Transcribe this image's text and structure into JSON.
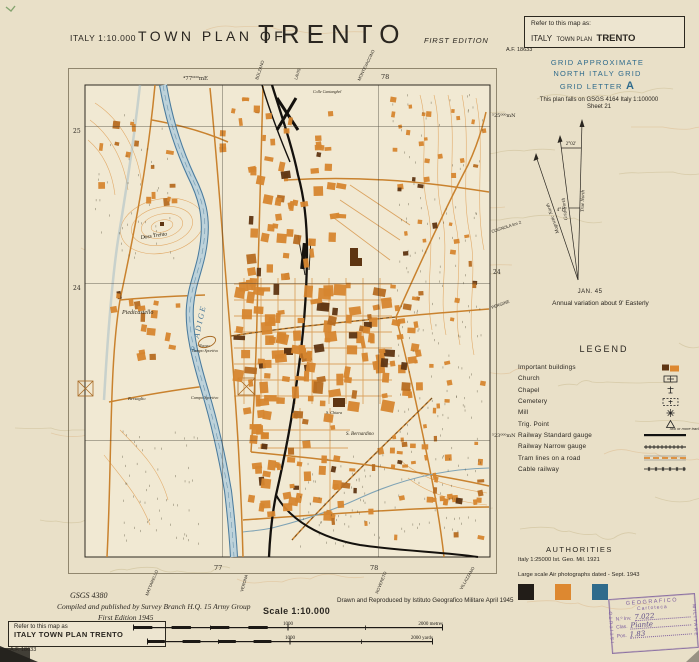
{
  "colors": {
    "accent_orange": "#d6862f",
    "dark_building": "#5e3512",
    "grid_blue": "#2f6b8c",
    "river_blue": "#4a7a9b",
    "stamp_purple": "#7d5e9e",
    "paper": "#e9e0c8"
  },
  "header": {
    "series_label": "ITALY 1:10.000",
    "title_prefix": "TOWN PLAN OF",
    "title": "TRENTO",
    "edition": "FIRST EDITION"
  },
  "refer_top": {
    "intro": "Refer to this map as:",
    "country": "ITALY",
    "series": "TOWN PLAN",
    "name": "TRENTO",
    "number": "A.F. 18633"
  },
  "grid_note": {
    "l1": "GRID APPROXIMATE",
    "l2": "NORTH ITALY GRID",
    "l3": "GRID LETTER",
    "letter": "A"
  },
  "falls_on": {
    "l1": "This plan falls on GSGS 4164 Italy 1:100000",
    "l2": "Sheet 21"
  },
  "declination": {
    "magnetic": "Magnetic North",
    "grid": "Grid North",
    "true_north": "True North",
    "angle_top": "2°02'",
    "angle_low": "4°11'",
    "date": "JAN. 45",
    "note": "Annual variation about 9' Easterly"
  },
  "legend": {
    "title": "LEGEND",
    "note": "Two or more tracks",
    "items": [
      {
        "label": "Important buildings",
        "symbol": "important-buildings"
      },
      {
        "label": "Church",
        "symbol": "church"
      },
      {
        "label": "Chapel",
        "symbol": "chapel"
      },
      {
        "label": "Cemetery",
        "symbol": "cemetery"
      },
      {
        "label": "Mill",
        "symbol": "mill"
      },
      {
        "label": "Trig. Point",
        "symbol": "trig-point"
      },
      {
        "label": "Railway Standard gauge",
        "symbol": "railway-standard",
        "note": true
      },
      {
        "label": "Railway Narrow gauge",
        "symbol": "railway-narrow"
      },
      {
        "label": "Tram lines on a road",
        "symbol": "tram-lines"
      },
      {
        "label": "Cable railway",
        "symbol": "cable-railway"
      }
    ]
  },
  "authorities": {
    "title": "AUTHORITIES",
    "source1": "Italy 1:25000  Ist. Geo. Mil.  1921",
    "source2": "Large scale Air photographs dated - Sept. 1943"
  },
  "swatches": [
    "#221d18",
    "#dd8830",
    "#2f6b8c"
  ],
  "scalebar": {
    "title": "Scale 1:10.000",
    "metres_mid": "1000",
    "metres_end": "2000 metres",
    "yards_mid": "1000",
    "yards_end": "2000 yards"
  },
  "footer": {
    "gsgs": "GSGS 4380",
    "compiled": "Compiled and published by Survey Branch H.Q. 15 Army Group",
    "edition": "First Edition 1945",
    "drawn": "Drawn and Reproduced by Istituto Geografico Militare April 1945"
  },
  "refer_bottom": {
    "intro": "Refer to this map as",
    "name": "ITALY  TOWN PLAN TRENTO",
    "number": "A.F. 18633"
  },
  "stamp": {
    "left": "ISTITUTO",
    "top": "GEOGRAFICO",
    "right": "MILITARE",
    "archive": "Cartoteca",
    "inv_label": "N.º Inv.",
    "inv_value": "7.022",
    "clas_label": "Clas.",
    "clas_value": "Piante",
    "pos_label": "Pos.",
    "pos_value": "1.83"
  },
  "map": {
    "grid_labels": {
      "easting": "⁴77⁰⁰⁰mE",
      "northing_top": "⁵25⁰⁰⁰mN",
      "northing_low": "⁵23⁰⁰⁰mN",
      "e1": "77",
      "e2": "78",
      "n25": "25",
      "n24": "24"
    },
    "labels": {
      "river": "F. ADIGE",
      "piedicastello": "Piedicastello",
      "doss": "Doss Trento",
      "bersaglio": "Bersaglio",
      "campo": "Campo Sportivo",
      "nuovo1": "Nuovo",
      "nuovo2": "Campo Sportivo",
      "bernardino": "S. Bernardino",
      "chiara": "S. Chiara",
      "colle": "Colle Cantanghel"
    },
    "roads_out": {
      "top1": "BOLZANO",
      "top2": "LAVIS",
      "top3": "MONTEVACCINO",
      "right1": "COGNOLA km 2",
      "right2": "PERGINE",
      "bottom1": "MATTARELLO",
      "bottom2": "VERONA",
      "bottom3": "ROVERETO",
      "bottom4": "VILLAZZANO"
    }
  }
}
